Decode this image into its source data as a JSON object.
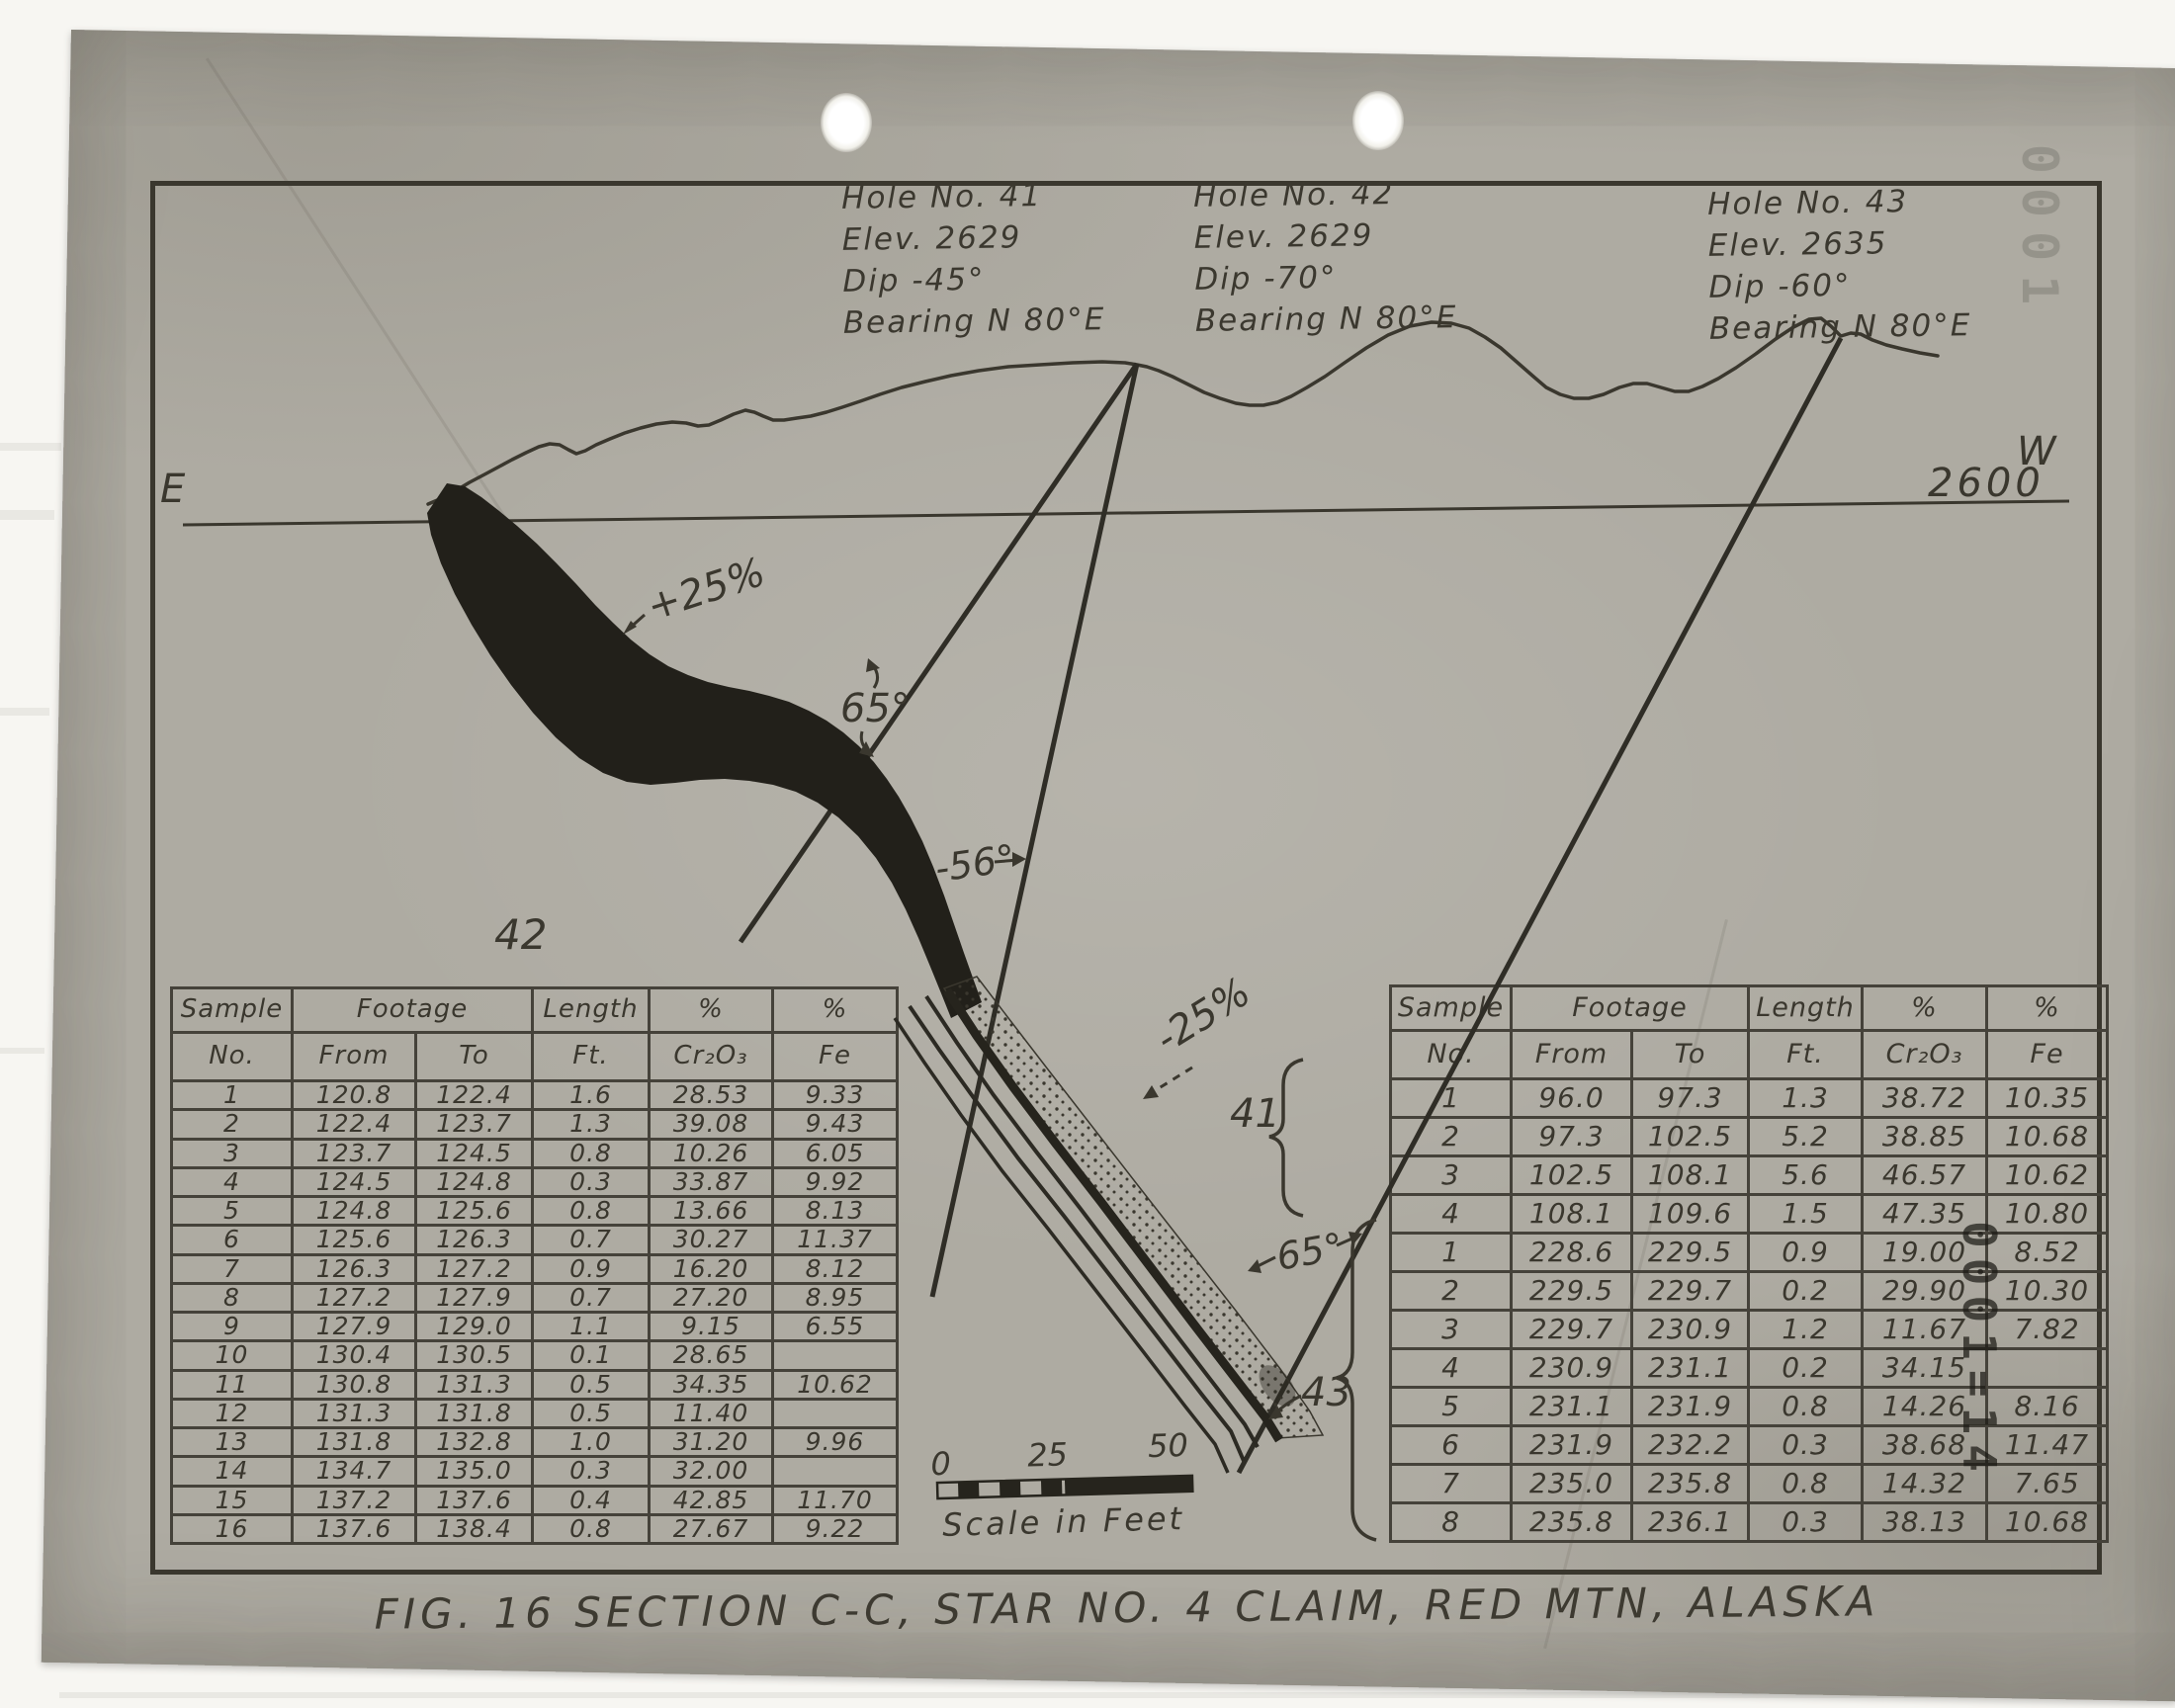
{
  "caption": "FIG. 16 SECTION C-C, STAR NO. 4 CLAIM, RED MTN, ALASKA",
  "holes": [
    {
      "name": "Hole No. 41",
      "elev": "Elev. 2629",
      "dip": "Dip -45°",
      "bearing": "Bearing N 80°E"
    },
    {
      "name": "Hole No. 42",
      "elev": "Elev. 2629",
      "dip": "Dip -70°",
      "bearing": "Bearing N 80°E"
    },
    {
      "name": "Hole No. 43",
      "elev": "Elev. 2635",
      "dip": "Dip -60°",
      "bearing": "Bearing N 80°E"
    }
  ],
  "diagram": {
    "east": "E",
    "west": "W",
    "datum_elevation": "2600",
    "grade_plus": "+25%",
    "angle_hole41_seam": "65°",
    "angle_hole42": "-56°",
    "grade_minus": "-25%",
    "angle_hole43_seam": "65°",
    "hole41_bracket_label": "41",
    "hole43_bracket_label": "43",
    "left_table_hole_label": "42"
  },
  "scale_bar": {
    "tick0": "0",
    "tick25": "25",
    "tick50": "50",
    "label": "Scale in Feet"
  },
  "stamps": {
    "table_overlay": "0001=14",
    "top_right_faint": "0001"
  },
  "table_headers": {
    "sample": "Sample",
    "no": "No.",
    "footage": "Footage",
    "from": "From",
    "to": "To",
    "length": "Length",
    "ft": "Ft.",
    "pct": "%",
    "cr2o3": "Cr₂O₃",
    "fe": "Fe"
  },
  "tables": {
    "left": {
      "rows": [
        [
          "1",
          "120.8",
          "122.4",
          "1.6",
          "28.53",
          "9.33"
        ],
        [
          "2",
          "122.4",
          "123.7",
          "1.3",
          "39.08",
          "9.43"
        ],
        [
          "3",
          "123.7",
          "124.5",
          "0.8",
          "10.26",
          "6.05"
        ],
        [
          "4",
          "124.5",
          "124.8",
          "0.3",
          "33.87",
          "9.92"
        ],
        [
          "5",
          "124.8",
          "125.6",
          "0.8",
          "13.66",
          "8.13"
        ],
        [
          "6",
          "125.6",
          "126.3",
          "0.7",
          "30.27",
          "11.37"
        ],
        [
          "7",
          "126.3",
          "127.2",
          "0.9",
          "16.20",
          "8.12"
        ],
        [
          "8",
          "127.2",
          "127.9",
          "0.7",
          "27.20",
          "8.95"
        ],
        [
          "9",
          "127.9",
          "129.0",
          "1.1",
          "9.15",
          "6.55"
        ],
        [
          "10",
          "130.4",
          "130.5",
          "0.1",
          "28.65",
          ""
        ],
        [
          "11",
          "130.8",
          "131.3",
          "0.5",
          "34.35",
          "10.62"
        ],
        [
          "12",
          "131.3",
          "131.8",
          "0.5",
          "11.40",
          ""
        ],
        [
          "13",
          "131.8",
          "132.8",
          "1.0",
          "31.20",
          "9.96"
        ],
        [
          "14",
          "134.7",
          "135.0",
          "0.3",
          "32.00",
          ""
        ],
        [
          "15",
          "137.2",
          "137.6",
          "0.4",
          "42.85",
          "11.70"
        ],
        [
          "16",
          "137.6",
          "138.4",
          "0.8",
          "27.67",
          "9.22"
        ]
      ]
    },
    "right": {
      "rows": [
        [
          "1",
          "96.0",
          "97.3",
          "1.3",
          "38.72",
          "10.35"
        ],
        [
          "2",
          "97.3",
          "102.5",
          "5.2",
          "38.85",
          "10.68"
        ],
        [
          "3",
          "102.5",
          "108.1",
          "5.6",
          "46.57",
          "10.62"
        ],
        [
          "4",
          "108.1",
          "109.6",
          "1.5",
          "47.35",
          "10.80"
        ],
        [
          "1",
          "228.6",
          "229.5",
          "0.9",
          "19.00",
          "8.52"
        ],
        [
          "2",
          "229.5",
          "229.7",
          "0.2",
          "29.90",
          "10.30"
        ],
        [
          "3",
          "229.7",
          "230.9",
          "1.2",
          "11.67",
          "7.82"
        ],
        [
          "4",
          "230.9",
          "231.1",
          "0.2",
          "34.15",
          ""
        ],
        [
          "5",
          "231.1",
          "231.9",
          "0.8",
          "14.26",
          "8.16"
        ],
        [
          "6",
          "231.9",
          "232.2",
          "0.3",
          "38.68",
          "11.47"
        ],
        [
          "7",
          "235.0",
          "235.8",
          "0.8",
          "14.32",
          "7.65"
        ],
        [
          "8",
          "235.8",
          "236.1",
          "0.3",
          "38.13",
          "10.68"
        ]
      ]
    }
  }
}
